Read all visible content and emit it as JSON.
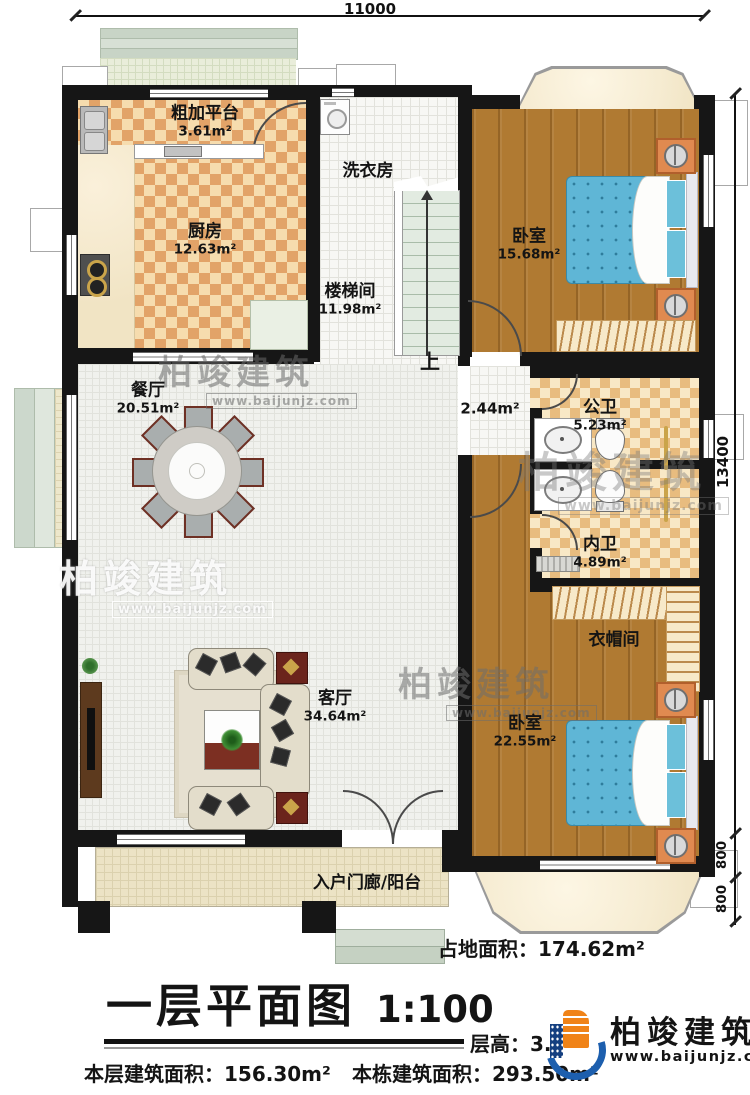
{
  "dims": {
    "width": "11000",
    "height": "13400",
    "seg_a": "800",
    "seg_b": "800"
  },
  "rooms": {
    "rough_platform": {
      "name": "粗加平台",
      "area": "3.61m²"
    },
    "kitchen": {
      "name": "厨房",
      "area": "12.63m²"
    },
    "laundry": {
      "name": "洗衣房"
    },
    "stairwell": {
      "name": "楼梯间",
      "area": "11.98m²"
    },
    "bedroom1": {
      "name": "卧室",
      "area": "15.68m²"
    },
    "dining": {
      "name": "餐厅",
      "area": "20.51m²"
    },
    "corridor": {
      "area": "2.44m²"
    },
    "public_bath": {
      "name": "公卫",
      "area": "5.23m²"
    },
    "private_bath": {
      "name": "内卫",
      "area": "4.89m²"
    },
    "cloakroom": {
      "name": "衣帽间"
    },
    "living": {
      "name": "客厅",
      "area": "34.64m²"
    },
    "bedroom2": {
      "name": "卧室",
      "area": "22.55m²"
    },
    "porch": {
      "name": "入户门廊/阳台"
    }
  },
  "stairs": {
    "up": "上"
  },
  "footer": {
    "site_area": "占地面积：174.62m²",
    "title": "一层平面图",
    "scale": "1:100",
    "floor_height": "层高：3.",
    "floor_area": "本层建筑面积：156.30m²",
    "building_area": "本栋建筑面积：293.50m²"
  },
  "brand": {
    "name": "柏竣建筑",
    "url": "www.baijunjz.com"
  }
}
